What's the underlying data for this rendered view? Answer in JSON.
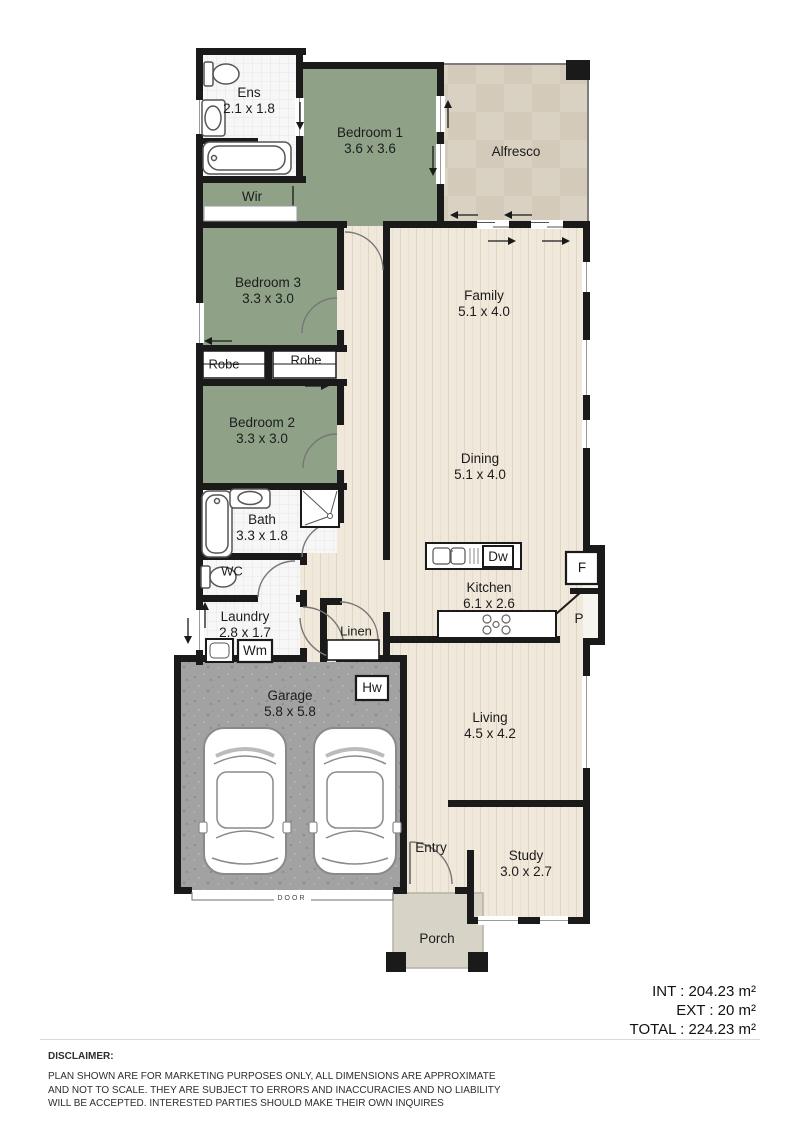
{
  "rooms": {
    "ens": {
      "name": "Ens",
      "dims": "2.1 x 1.8"
    },
    "bedroom1": {
      "name": "Bedroom 1",
      "dims": "3.6 x 3.6"
    },
    "alfresco": {
      "name": "Alfresco"
    },
    "wir": {
      "name": "Wir"
    },
    "bedroom3": {
      "name": "Bedroom 3",
      "dims": "3.3 x 3.0"
    },
    "family": {
      "name": "Family",
      "dims": "5.1 x 4.0"
    },
    "robe_left": {
      "name": "Robe"
    },
    "robe_right": {
      "name": "Robe"
    },
    "bedroom2": {
      "name": "Bedroom 2",
      "dims": "3.3 x 3.0"
    },
    "dining": {
      "name": "Dining",
      "dims": "5.1 x 4.0"
    },
    "bath": {
      "name": "Bath",
      "dims": "3.3 x 1.8"
    },
    "wc": {
      "name": "WC"
    },
    "kitchen": {
      "name": "Kitchen",
      "dims": "6.1 x 2.6"
    },
    "fridge": {
      "name": "F"
    },
    "pantry": {
      "name": "P"
    },
    "laundry": {
      "name": "Laundry",
      "dims": "2.8 x 1.7"
    },
    "linen": {
      "name": "Linen"
    },
    "wm": {
      "name": "Wm"
    },
    "dw": {
      "name": "Dw"
    },
    "hw": {
      "name": "Hw"
    },
    "garage": {
      "name": "Garage",
      "dims": "5.8 x 5.8"
    },
    "living": {
      "name": "Living",
      "dims": "4.5 x 4.2"
    },
    "entry": {
      "name": "Entry"
    },
    "study": {
      "name": "Study",
      "dims": "3.0 x 2.7"
    },
    "porch": {
      "name": "Porch"
    },
    "garage_door": {
      "name": "DOOR"
    }
  },
  "summary": {
    "int": "INT : 204.23 m²",
    "ext": "EXT : 20 m²",
    "total": "TOTAL : 224.23 m²"
  },
  "disclaimer": {
    "heading": "DISCLAIMER:",
    "body": "PLAN SHOWN ARE FOR MARKETING PURPOSES ONLY, ALL DIMENSIONS ARE APPROXIMATE AND NOT TO SCALE. THEY ARE SUBJECT TO ERRORS AND INACCURACIES AND NO LIABILITY WILL BE ACCEPTED. INTERESTED PARTIES SHOULD MAKE THEIR OWN INQUIRES"
  },
  "colors": {
    "wall": "#1a1a1a",
    "bedroom_green": "#8fa288",
    "floor_wood": "#f0e9db",
    "alfresco_tile": "#d8d0c0",
    "garage_grey": "#a2a2a2",
    "porch_grey": "#d7d3c7"
  }
}
